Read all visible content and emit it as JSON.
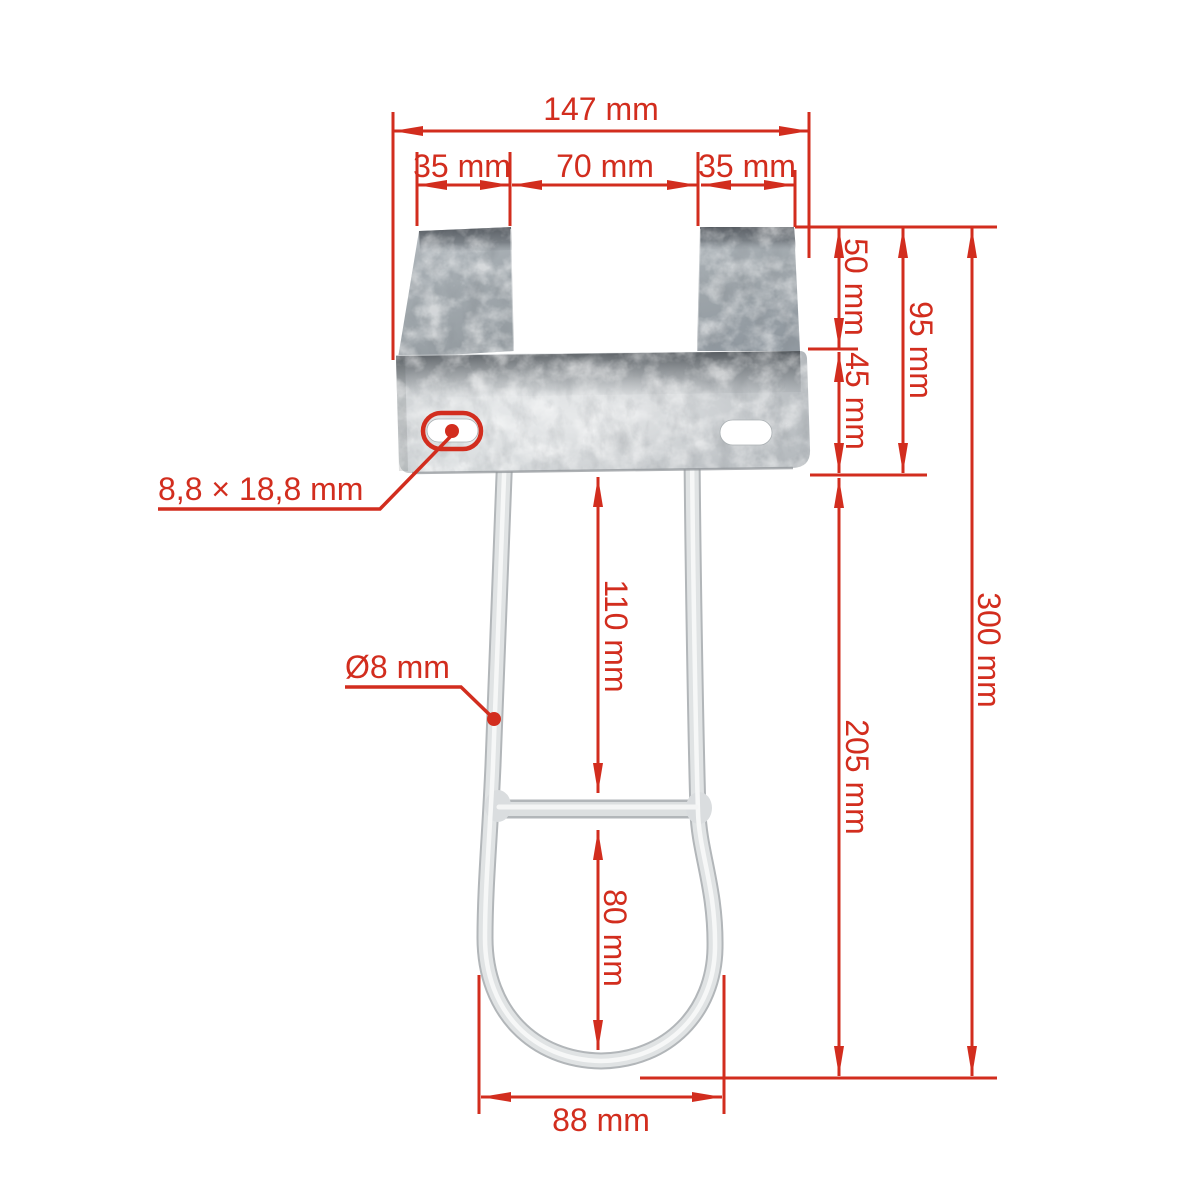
{
  "diagram": {
    "type": "technical-dimension-drawing",
    "subject": "galvanized mounting bracket with wire bow",
    "background": "#ffffff",
    "accent_red": "#d22d1e",
    "dimensions": {
      "total_width": "147 mm",
      "left_tab_width": "35 mm",
      "center_gap_width": "70 mm",
      "right_tab_width": "35 mm",
      "tab_height": "50 mm",
      "plate_height": "45 mm",
      "bracket_height": "95 mm",
      "overall_height": "300 mm",
      "upper_bow_section": "110 mm",
      "lower_bow_section": "80 mm",
      "bow_length": "205 mm",
      "bow_width": "88 mm"
    },
    "callouts": {
      "slot_size": "8,8 × 18,8 mm",
      "wire_diameter": "Ø8 mm"
    }
  }
}
